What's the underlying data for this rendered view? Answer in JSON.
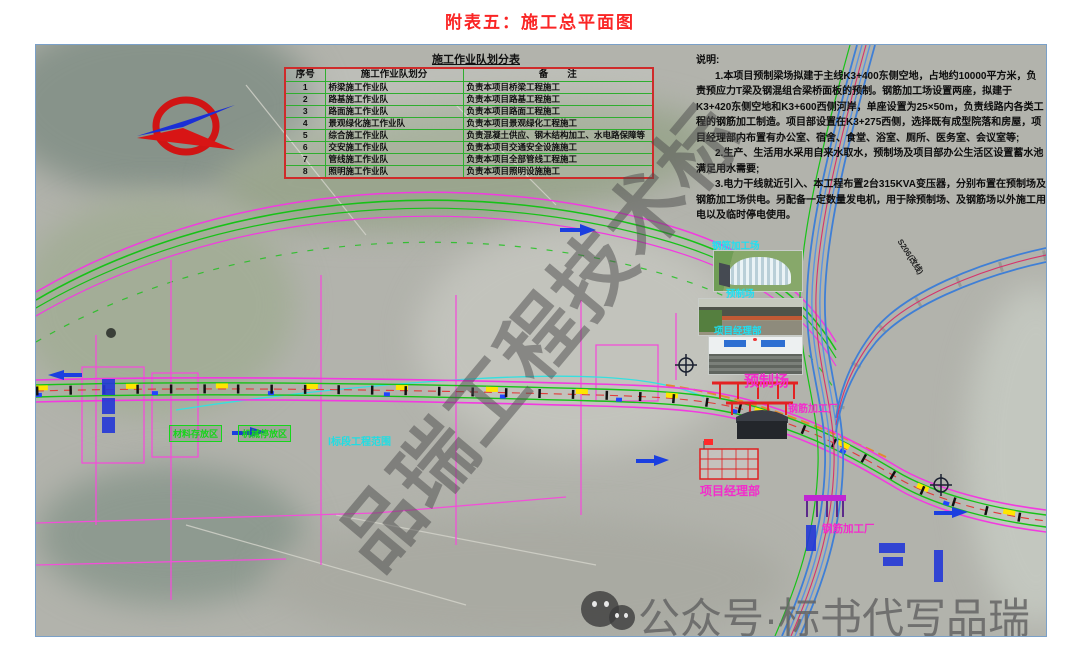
{
  "page": {
    "title": "附表五：施工总平面图"
  },
  "legend_table": {
    "title": "施工作业队划分表",
    "headers": [
      "序号",
      "施工作业队划分",
      "备　　注"
    ],
    "rows": [
      [
        "1",
        "桥梁施工作业队",
        "负责本项目桥梁工程施工"
      ],
      [
        "2",
        "路基施工作业队",
        "负责本项目路基工程施工"
      ],
      [
        "3",
        "路面施工作业队",
        "负责本项目路面工程施工"
      ],
      [
        "4",
        "景观绿化施工作业队",
        "负责本项目景观绿化工程施工"
      ],
      [
        "5",
        "综合施工作业队",
        "负责混凝土供应、钢木结构加工、水电路保障等"
      ],
      [
        "6",
        "交安施工作业队",
        "负责本项目交通安全设施施工"
      ],
      [
        "7",
        "管线施工作业队",
        "负责本项目全部管线工程施工"
      ],
      [
        "8",
        "照明施工作业队",
        "负责本项目照明设施施工"
      ]
    ]
  },
  "notes": {
    "heading": "说明:",
    "items": [
      "1.本项目预制梁场拟建于主线K3+400东侧空地，占地约10000平方米，负责预应力T梁及钢混组合梁桥面板的预制。钢筋加工场设置两座，拟建于K3+420东侧空地和K3+600西侧河岸，单座设置为25×50m，负责线路内各类工程的钢筋加工制造。项目部设置在K3+275西侧，选择既有成型院落和房屋，项目经理部内布置有办公室、宿舍、食堂、浴室、厕所、医务室、会议室等;",
      "2.生产、生活用水采用自来水取水，预制场及项目部办公生活区设置蓄水池满足用水需要;",
      "3.电力干线就近引入、本工程布置2台315KVA变压器，分别布置在预制场及钢筋加工场供电。另配备一定数量发电机，用于除预制场、及钢筋场以外施工用电以及临时停电使用。"
    ]
  },
  "photo_labels": {
    "steel_yard": "钢筋加工场",
    "precast_yard": "预制场",
    "project_office": "项目经理部"
  },
  "map_labels": {
    "precast_yard": "预制场",
    "steel_plant_a": "钢筋加工厂",
    "project_office": "项目经理部",
    "steel_plant_b": "钢筋加工厂",
    "material_area": "材料存放区",
    "machinery_area": "机械停放区",
    "section_scope": "Ⅰ标段工程范围",
    "s206": "S206(改线)"
  },
  "watermarks": {
    "diagonal": "品瑞工程技术标",
    "bottom": "公众号·标书代写品瑞"
  },
  "colors": {
    "title_red": "#fa2525",
    "table_border_red": "#cf2b2b",
    "table_grid_green": "#2fae2f",
    "label_magenta": "#f32ccc",
    "label_cyan": "#1fe0f2",
    "label_green": "#17d51c",
    "road_magenta": "#f23ae0",
    "road_green": "#17c217",
    "highway_blue": "#3f7fd6"
  }
}
